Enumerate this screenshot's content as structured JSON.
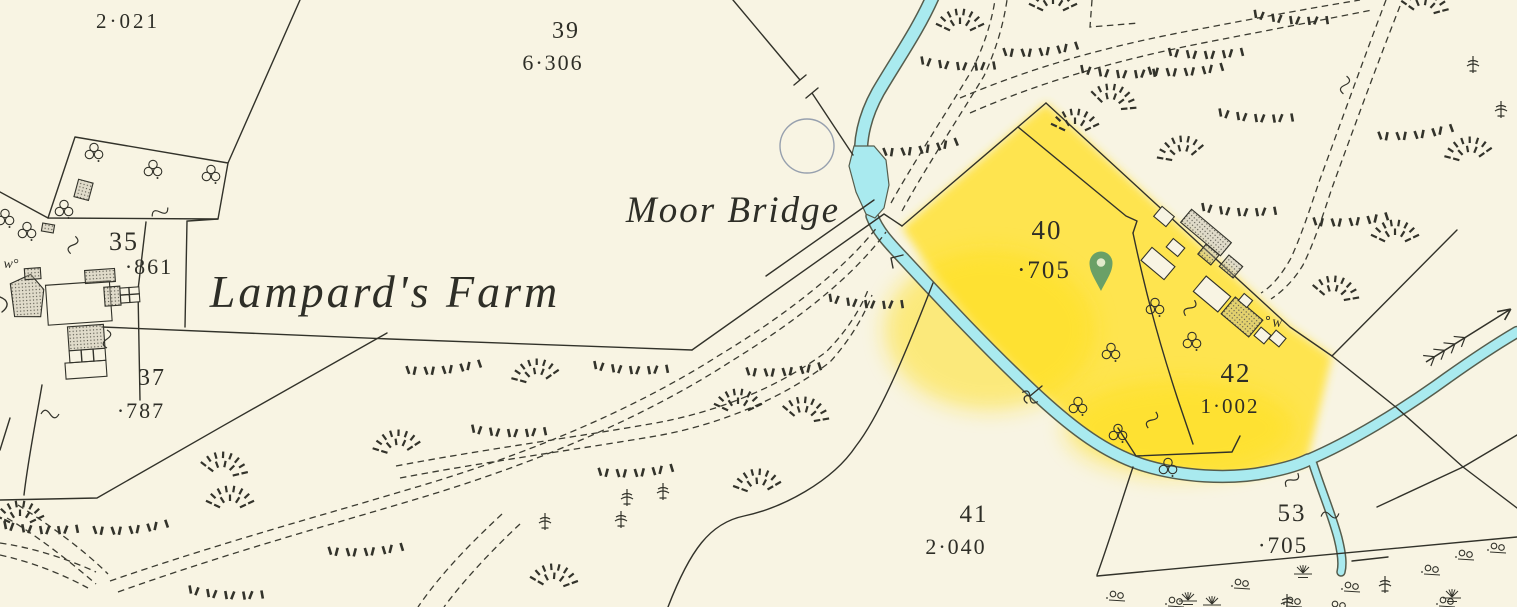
{
  "map": {
    "type": "historical-os-map",
    "place_labels": {
      "bridge": "Moor Bridge",
      "farm": "Lampard's Farm",
      "well_small": "w°",
      "well": "W"
    },
    "parcels": [
      {
        "number": "",
        "acreage": "2·021",
        "highlighted": false
      },
      {
        "number": "39",
        "acreage": "6·306",
        "highlighted": false
      },
      {
        "number": "35",
        "acreage": "·861",
        "highlighted": false
      },
      {
        "number": "37",
        "acreage": "·787",
        "highlighted": false
      },
      {
        "number": "40",
        "acreage": "·705",
        "highlighted": true
      },
      {
        "number": "42",
        "acreage": "1·002",
        "highlighted": true
      },
      {
        "number": "41",
        "acreage": "2·040",
        "highlighted": false
      },
      {
        "number": "53",
        "acreage": "·705",
        "highlighted": false
      }
    ],
    "marker": {
      "type": "location-pin",
      "color": "#55966B"
    },
    "colors": {
      "paper": "#F8F4E3",
      "ink": "#32322A",
      "water": "#A9EAEF",
      "water_outline": "#565D4D",
      "highlight": "#FFE23A",
      "highlight_label": "#8A7B20",
      "selection_circle": "#97A0AE"
    }
  }
}
